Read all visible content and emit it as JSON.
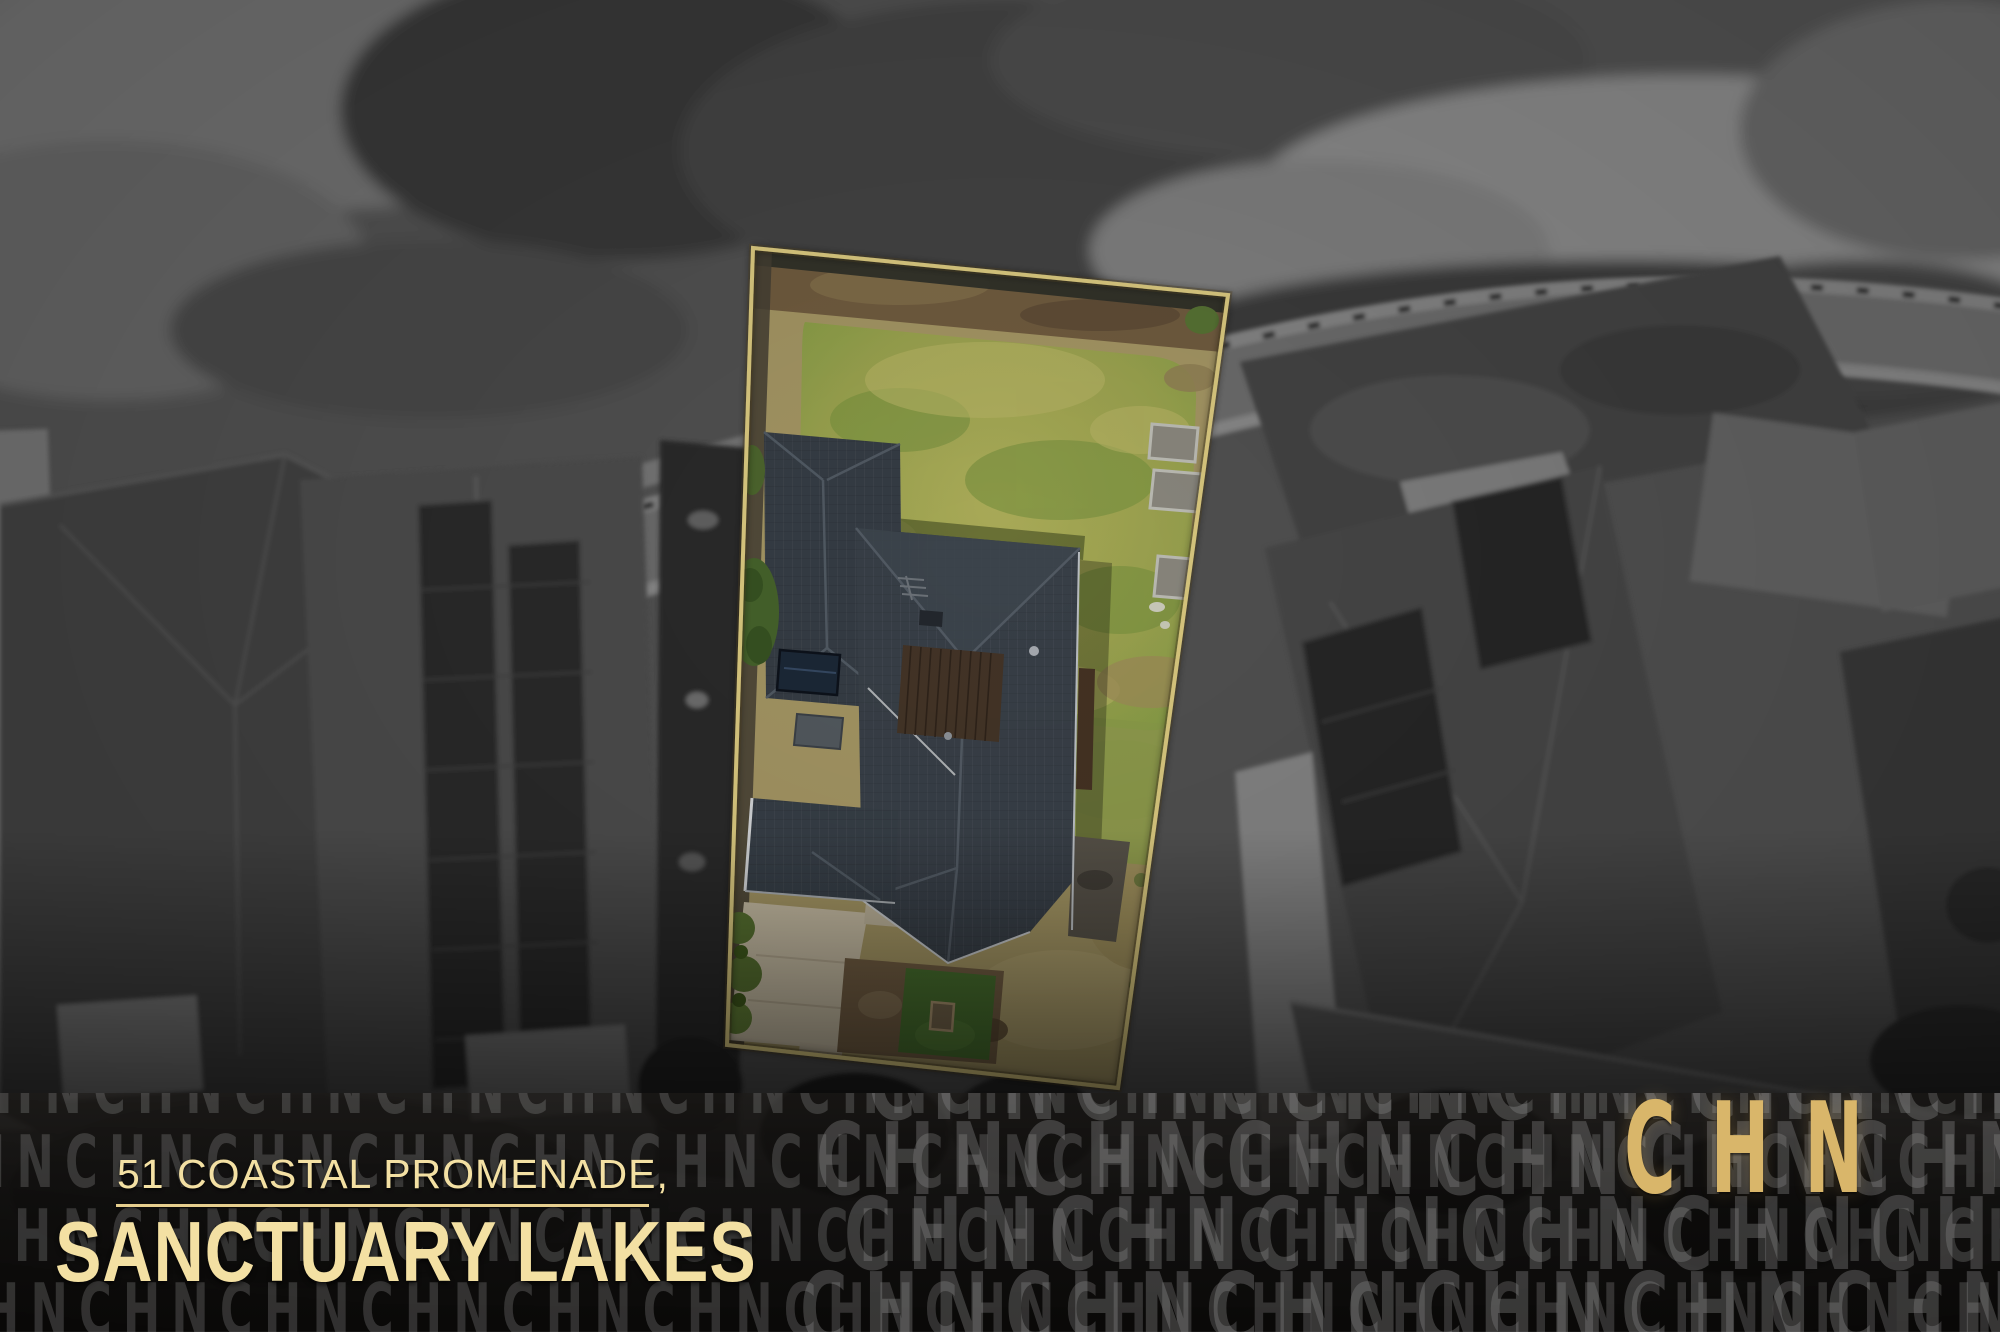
{
  "address": {
    "line1": "51 COASTAL PROMENADE,",
    "line2": "SANCTUARY LAKES"
  },
  "brand": {
    "logo_text": "CHN"
  },
  "watermark": {
    "unit": "CHN",
    "rows": 4,
    "repeats_per_row": 16,
    "row_offsets_px": [
      -34,
      -62,
      -16,
      -48
    ],
    "big_rows": 4,
    "big_repeats": 7,
    "big_row_offsets_px": [
      -12,
      -64,
      -36,
      -80
    ]
  },
  "colors": {
    "gold_text": "#F3E0A3",
    "gold_line": "#E6CE8E",
    "logo_gold": "#D9B66A",
    "boundary_gold": "#EFDC8C",
    "wm_color": "rgba(168,168,168,0.25)",
    "wm_color_big": "rgba(162,162,162,0.30)",
    "lawn_green": "#A9B156",
    "roof_slate": "#3E464F",
    "driveway_concrete": "#D9CDB3"
  }
}
